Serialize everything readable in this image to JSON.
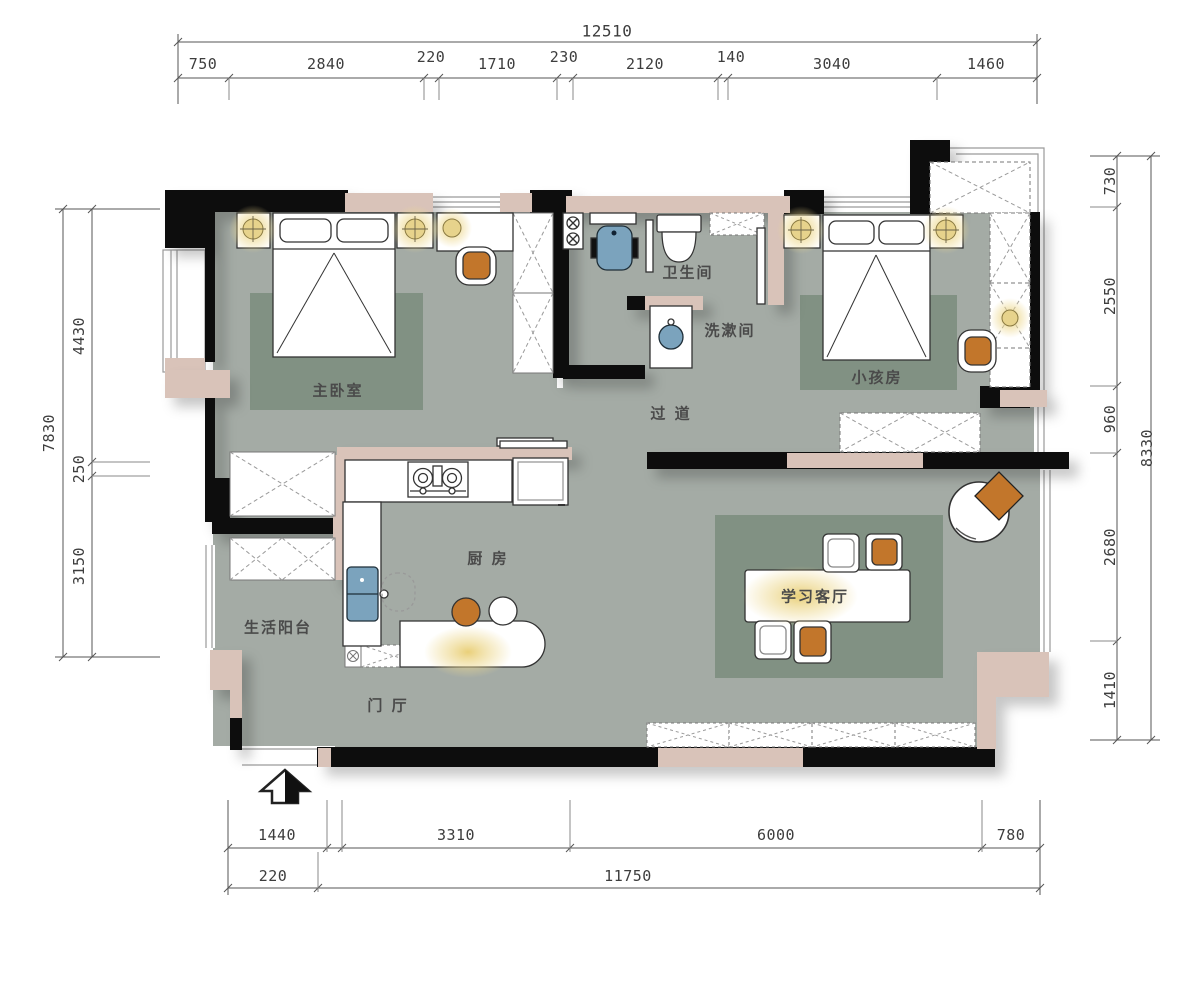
{
  "dimensions": {
    "top": {
      "total": "12510",
      "segments": [
        "750",
        "2840",
        "220",
        "1710",
        "230",
        "2120",
        "140",
        "3040",
        "1460"
      ]
    },
    "left": {
      "total": "7830",
      "segments": [
        "4430",
        "250",
        "3150"
      ]
    },
    "right": {
      "total": "8330",
      "segments": [
        "730",
        "2550",
        "960",
        "2680",
        "1410"
      ]
    },
    "bottom": {
      "upper": [
        "1440",
        "3310",
        "6000",
        "780"
      ],
      "lower": [
        "220",
        "11750"
      ]
    }
  },
  "rooms": {
    "master_bedroom": "主卧室",
    "bathroom": "卫生间",
    "washroom": "洗漱间",
    "kids_room": "小孩房",
    "corridor": "过 道",
    "kitchen": "厨 房",
    "balcony": "生活阳台",
    "entry_hall": "门 厅",
    "study_living": "学习客厅"
  },
  "colors": {
    "floor": "#a4aba5",
    "rug": "#7b8c7d",
    "wall_black": "#0d0d0d",
    "wall_fill": "#d9c3b9",
    "fixture_blue": "#7ba3bd",
    "wood": "#c2762b",
    "lamp_glow": "#ecd27b",
    "shadow": "#cfcfcf"
  }
}
